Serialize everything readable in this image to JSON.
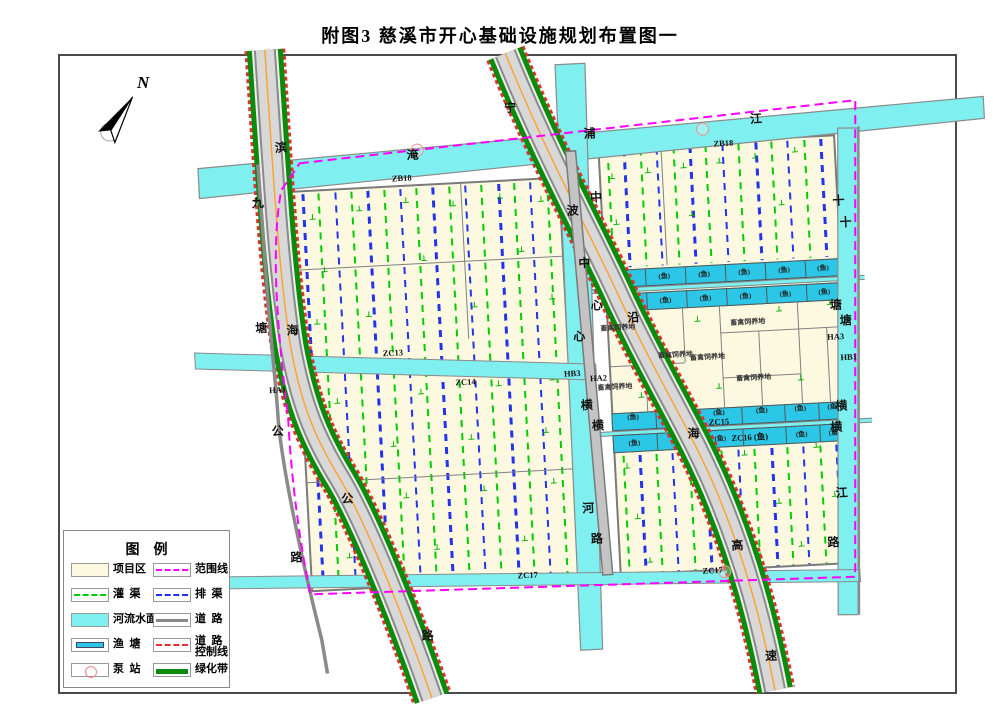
{
  "title": "附图3  慈溪市开心基础设施规划布置图一",
  "north_label": "N",
  "colors": {
    "parcel": "#fcf9e0",
    "river": "#80efef",
    "pond": "#2cc6e6",
    "boundary": "#ff00ff",
    "irrigation": "#00cc00",
    "drainage": "#2233ee",
    "road_gray": "#8a8a8a",
    "green_belt": "#0a8c0a",
    "road_control": "#e03030",
    "center_line": "#ffa028"
  },
  "legend": {
    "title": "图    例",
    "items": [
      {
        "label": "项目区",
        "type": "area-parcel",
        "col": 0,
        "row": 0
      },
      {
        "label": "范围线",
        "type": "line-magenta-dash",
        "col": 1,
        "row": 0
      },
      {
        "label": "灌  渠",
        "type": "line-green-dash",
        "col": 0,
        "row": 1
      },
      {
        "label": "排  渠",
        "type": "line-blue-dash",
        "col": 1,
        "row": 1
      },
      {
        "label": "河流水面",
        "type": "area-river",
        "col": 0,
        "row": 2
      },
      {
        "label": "道  路",
        "type": "line-gray",
        "col": 1,
        "row": 2
      },
      {
        "label": "渔  塘",
        "type": "area-pond",
        "col": 0,
        "row": 3
      },
      {
        "label": "道  路",
        "label2": "控制线",
        "type": "line-red-dash",
        "col": 1,
        "row": 3
      },
      {
        "label": "泵  站",
        "type": "pump",
        "col": 0,
        "row": 4
      },
      {
        "label": "绿化带",
        "type": "line-green-thick",
        "col": 1,
        "row": 4
      }
    ]
  },
  "map": {
    "road_labels": [
      {
        "name": "binhai-road",
        "chars": [
          [
            "滨",
            293,
            132
          ],
          [
            "海",
            295,
            315
          ],
          [
            "公",
            341,
            486
          ],
          [
            "路",
            414,
            627
          ]
        ]
      },
      {
        "name": "jiutang-road",
        "chars": [
          [
            "九",
            267,
            186
          ],
          [
            "塘",
            264,
            311
          ],
          [
            "公",
            275,
            415
          ],
          [
            "路",
            287,
            542
          ]
        ]
      },
      {
        "name": "yanhai-expressway",
        "chars": [
          [
            "宁",
            524,
            104
          ],
          [
            "波",
            581,
            210
          ],
          [
            "沿",
            636,
            320
          ],
          [
            "海",
            690,
            439
          ],
          [
            "高",
            728,
            553
          ],
          [
            "速",
            756,
            665
          ]
        ]
      },
      {
        "name": "zhongxin-river",
        "chars": [
          [
            "中",
            590,
            263
          ],
          [
            "心",
            581,
            336
          ],
          [
            "横",
            585,
            405
          ],
          [
            "河",
            581,
            508
          ]
        ]
      },
      {
        "name": "zhongxin-road",
        "chars": [
          [
            "中",
            605,
            198
          ],
          [
            "心",
            600,
            306
          ],
          [
            "横",
            595,
            426
          ],
          [
            "路",
            588,
            539
          ]
        ]
      },
      {
        "name": "yanpu-river",
        "chars": [
          [
            "淹",
            424,
            146
          ],
          [
            "浦",
            602,
            134
          ],
          [
            "江",
            769,
            128
          ]
        ]
      },
      {
        "name": "shitang-river",
        "chars": [
          [
            "十",
            853,
            236
          ],
          [
            "塘",
            848,
            334
          ],
          [
            "横",
            839,
            419
          ],
          [
            "江",
            835,
            506
          ]
        ]
      },
      {
        "name": "tanghern-road",
        "chars": [
          [
            "十",
            847,
            214
          ],
          [
            "塘",
            839,
            318
          ],
          [
            "横",
            833,
            440
          ],
          [
            "路",
            824,
            555
          ]
        ]
      }
    ],
    "zone_labels": [
      [
        "ZB18",
        412,
        169
      ],
      [
        "ZB18",
        735,
        151
      ],
      [
        "ZC13",
        394,
        343
      ],
      [
        "ZC14",
        465,
        376
      ],
      [
        "HB3",
        572,
        373
      ],
      [
        "HA2",
        598,
        379
      ],
      [
        "HA1",
        277,
        374
      ],
      [
        "HA3",
        837,
        350
      ],
      [
        "HB1",
        849,
        371
      ],
      [
        "ZC15",
        716,
        429
      ],
      [
        "ZC16 (鱼)",
        746,
        446
      ],
      [
        "ZC17",
        517,
        572
      ],
      [
        "ZC17",
        702,
        577
      ]
    ],
    "fish_label": "(鱼)",
    "fish_rows": [
      {
        "y": 272,
        "h": 18,
        "xs": [
          609,
          649,
          689,
          729,
          769,
          809,
          847
        ],
        "label_y": 281,
        "skip": []
      },
      {
        "y": 296,
        "h": 18,
        "xs": [
          609,
          649,
          689,
          729,
          769,
          809,
          847
        ],
        "label_y": 305,
        "skip": []
      },
      {
        "y": 415,
        "h": 18,
        "xs": [
          609,
          652,
          695,
          738,
          781,
          815,
          847
        ],
        "label_y": 420,
        "skip": []
      },
      {
        "y": 437,
        "h": 18,
        "xs": [
          609,
          652,
          695,
          738,
          781,
          815,
          847
        ],
        "label_y": 446,
        "skip": [
          3
        ]
      }
    ],
    "livestock": {
      "label": "畜禽饲养地",
      "positions": [
        [
          620,
          330
        ],
        [
          750,
          331
        ],
        [
          708,
          364
        ],
        [
          753,
          387
        ],
        [
          614,
          389
        ],
        [
          676,
          360
        ]
      ]
    },
    "pumps": [
      [
        715,
        136
      ],
      [
        429,
        142
      ],
      [
        714,
        579
      ]
    ],
    "green_markers": [
      [
        321,
        203
      ],
      [
        368,
        197
      ],
      [
        415,
        191
      ],
      [
        462,
        197
      ],
      [
        509,
        192
      ],
      [
        550,
        197
      ],
      [
        330,
        256
      ],
      [
        430,
        250
      ],
      [
        528,
        246
      ],
      [
        320,
        308
      ],
      [
        372,
        303
      ],
      [
        478,
        299
      ],
      [
        556,
        295
      ],
      [
        336,
        388
      ],
      [
        420,
        383
      ],
      [
        498,
        379
      ],
      [
        552,
        376
      ],
      [
        326,
        438
      ],
      [
        390,
        434
      ],
      [
        468,
        431
      ],
      [
        543,
        428
      ],
      [
        330,
        490
      ],
      [
        400,
        486
      ],
      [
        478,
        483
      ],
      [
        548,
        479
      ],
      [
        340,
        543
      ],
      [
        428,
        539
      ],
      [
        516,
        535
      ],
      [
        622,
        178
      ],
      [
        658,
        174
      ],
      [
        694,
        171
      ],
      [
        730,
        168
      ],
      [
        766,
        165
      ],
      [
        806,
        161
      ],
      [
        624,
        224
      ],
      [
        700,
        219
      ],
      [
        790,
        213
      ],
      [
        617,
        330
      ],
      [
        700,
        325
      ],
      [
        782,
        319
      ],
      [
        833,
        315
      ],
      [
        640,
        398
      ],
      [
        718,
        393
      ],
      [
        800,
        389
      ],
      [
        622,
        468
      ],
      [
        680,
        465
      ],
      [
        740,
        461
      ],
      [
        812,
        457
      ],
      [
        630,
        519
      ],
      [
        700,
        515
      ],
      [
        772,
        511
      ],
      [
        828,
        507
      ],
      [
        640,
        563
      ],
      [
        712,
        559
      ],
      [
        792,
        555
      ]
    ],
    "dash_groups": [
      {
        "x0": 311,
        "step": 16.3,
        "count": 16,
        "y": 180,
        "h": 394,
        "start": "blue"
      },
      {
        "x0": 618,
        "step": 16.4,
        "count": 14,
        "y": 152,
        "h": 118,
        "start": "green"
      },
      {
        "x0": 618,
        "step": 16.4,
        "count": 14,
        "y": 458,
        "h": 118,
        "start": "green"
      }
    ],
    "livestock_vlines": [
      [
        645,
        314,
        101
      ],
      [
        685,
        314,
        54
      ],
      [
        722,
        314,
        101
      ],
      [
        760,
        340,
        75
      ],
      [
        800,
        314,
        101
      ],
      [
        828,
        340,
        75
      ]
    ],
    "livestock_hlines": [
      [
        722,
        340,
        125
      ],
      [
        609,
        368,
        76
      ],
      [
        722,
        385,
        78
      ]
    ]
  }
}
